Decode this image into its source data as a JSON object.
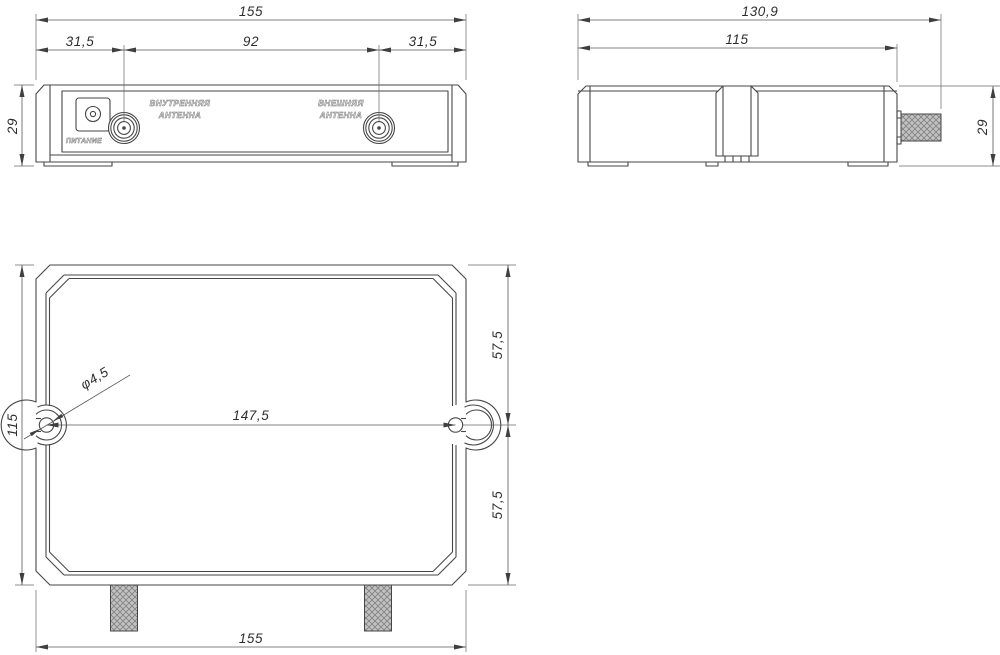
{
  "colors": {
    "background": "#ffffff",
    "line": "#464646",
    "dimension_line": "#585858",
    "text": "#2e2e2e",
    "stud_hatch_fill": "#c2c2c2",
    "stud_hatch_line": "#808080"
  },
  "front_view": {
    "dim_total_width": "155",
    "dim_left_offset": "31,5",
    "dim_connector_span": "92",
    "dim_right_offset": "31,5",
    "dim_height": "29",
    "power_label": "ПИТАНИЕ",
    "internal_antenna_label_line1": "ВНУТРЕННЯЯ",
    "internal_antenna_label_line2": "АНТЕННА",
    "external_antenna_label_line1": "ВНЕШНЯЯ",
    "external_antenna_label_line2": "АНТЕННА"
  },
  "side_view": {
    "dim_total_depth": "130,9",
    "dim_body_depth": "115",
    "dim_height": "29"
  },
  "bottom_view": {
    "dim_plate_height": "115",
    "dim_slot_to_top": "57,5",
    "dim_slot_to_bottom": "57,5",
    "dim_slot_span": "147,5",
    "dim_hole_diameter": "φ4,5",
    "dim_total_width": "155"
  }
}
